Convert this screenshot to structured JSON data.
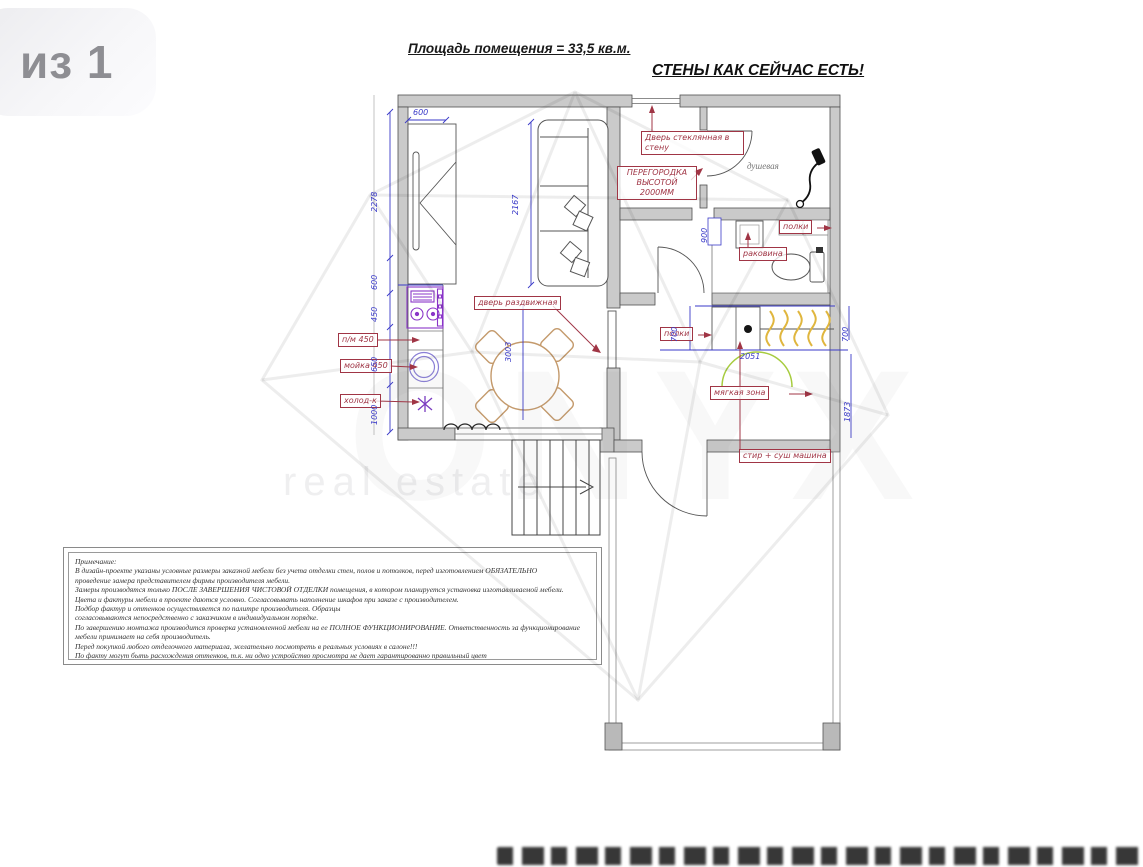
{
  "page_badge": "из 1",
  "header": {
    "area_title": "Площадь помещения = 33,5 кв.м.",
    "walls_title": "СТЕНЫ КАК СЕЙЧАС ЕСТЬ!"
  },
  "watermark": {
    "brand": "ONYX",
    "tagline": "real estate"
  },
  "plan": {
    "rooms": {
      "shower": "душевая"
    },
    "labels": {
      "sliding_door": "дверь раздвижная",
      "partition_line1": "ПЕРЕГОРОДКА",
      "partition_line2": "ВЫСОТОЙ",
      "partition_line3": "2000ММ",
      "glass_door_line1": "Дверь стеклянная в",
      "glass_door_line2": "стену",
      "shelves_wc": "полки",
      "sink_wc": "раковина",
      "shelves_closet": "полки",
      "soft_zone": "мягкая зона",
      "washer_dryer": "стир + суш машина",
      "dishwasher": "п/м 450",
      "kitchen_sink": "мойка 450",
      "fridge": "холод-к"
    },
    "dimensions": {
      "top_width": "600",
      "left_a": "2278",
      "left_b": "600",
      "left_c": "450",
      "left_d": "650",
      "left_e": "1000",
      "sofa": "2167",
      "room_depth": "3003",
      "wc": "900",
      "closet_left": "700",
      "closet_right": "700",
      "closet_width": "2051",
      "right_depth": "1873"
    }
  },
  "notes": {
    "lines": [
      "Примечание:",
      "В дизайн-проекте указаны условные размеры заказной мебели без учета отделки стен, полов и потолков, перед изготовлением ОБЯЗАТЕЛЬНО",
      "проведение замера представителем фирмы производителя мебели.",
      "Замеры производятся только ПОСЛЕ ЗАВЕРШЕНИЯ ЧИСТОВОЙ ОТДЕЛКИ помещения, в котором планируется установка изготавливаемой мебели.",
      "Цвета и фактуры мебели в проекте даются условно. Согласовывать наполнение шкафов при заказе с производителем.",
      "Подбор фактур и оттенков осуществляется по палитре производителя. Образцы",
      "согласовываются непосредственно с заказчиком в индивидуальном порядке.",
      "По завершению монтажа производится проверка установленной мебели на ее ПОЛНОЕ ФУНКЦИОНИРОВАНИЕ. Ответственность за функционирование",
      "мебели принимает на себя производитель.",
      "Перед покупкой любого отделочного материала, желательно посмотреть в реальных условиях в салоне!!!",
      "По факту могут быть расхождения оттенков,  т.к. ни одно устройство просмотра не дает гарантированно правильный цвет"
    ]
  },
  "colors": {
    "wall": "#c9c9c9",
    "dimension_blue": "#3a3ac8",
    "annotation_red": "#a03545",
    "appliance_purple": "#8a35c8",
    "furniture_wood": "#c49a6c",
    "door_green": "#a7cc3f",
    "hanger_yellow": "#e0b63e"
  }
}
